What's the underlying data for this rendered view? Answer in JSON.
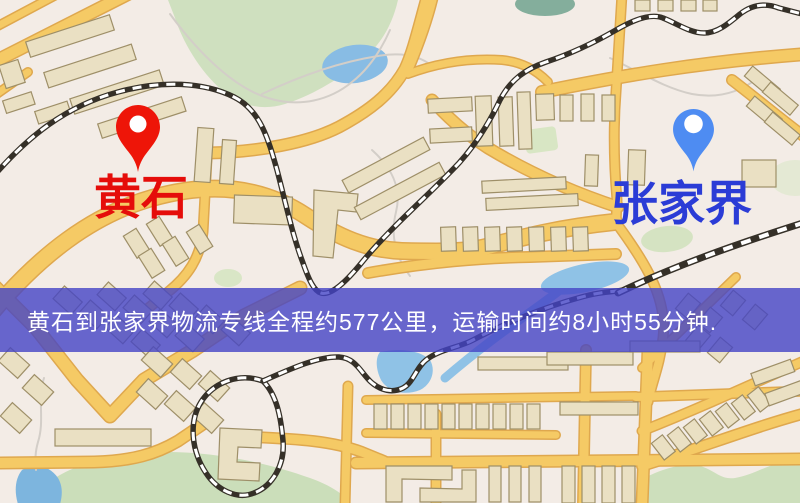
{
  "map": {
    "banner": {
      "text": "黄石到张家界物流专线全程约577公里，运输时间约8小时55分钟.",
      "background_color": "#4444c6",
      "text_color": "#ffffff"
    },
    "markers": [
      {
        "name": "origin",
        "label": "黄石",
        "pin_icon": "red-map-pin",
        "pin_color": "#ee1508",
        "label_color": "#e50d0a"
      },
      {
        "name": "destination",
        "label": "张家界",
        "pin_icon": "blue-map-pin",
        "pin_color": "#4e8cf2",
        "label_color": "#2b3cd6"
      }
    ],
    "palette": {
      "road": "#f5ca65",
      "road_casing": "#dfa84e",
      "building": "#eae0c3",
      "park": "#cfe0bf",
      "water": "#85b9e2",
      "railway": "#353028",
      "base": "#f3ece6"
    }
  }
}
